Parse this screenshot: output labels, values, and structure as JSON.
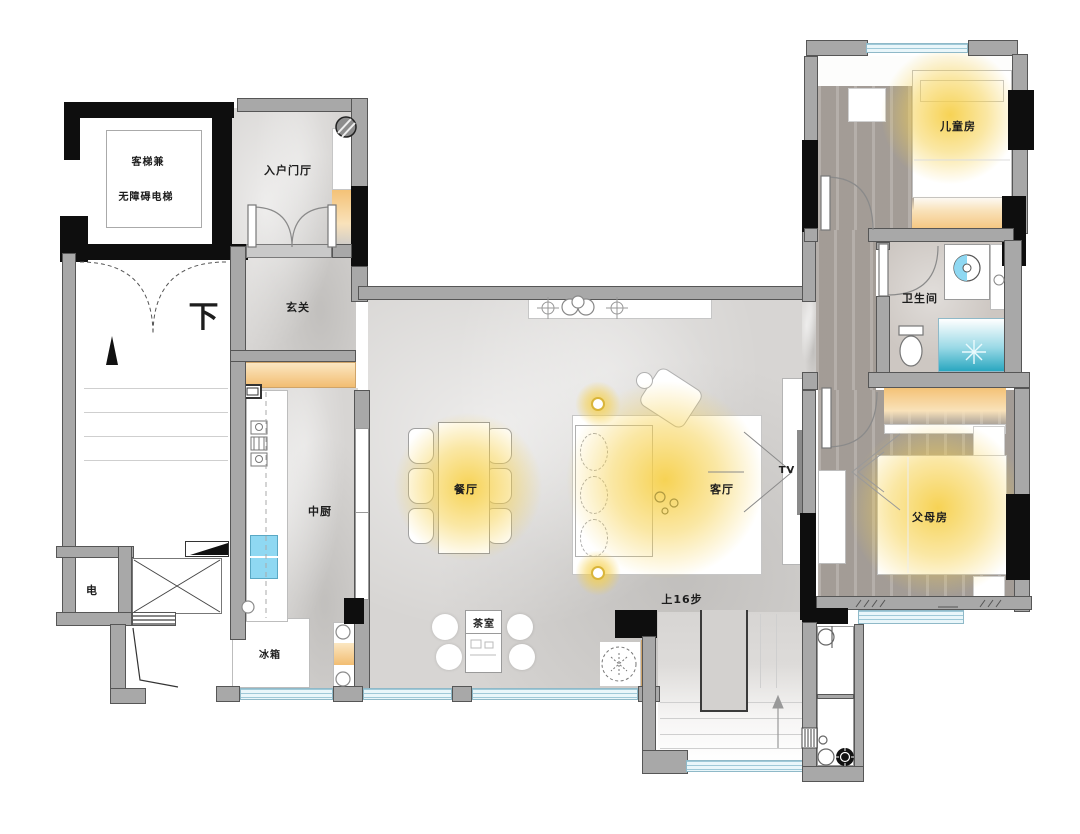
{
  "plan_title": "apartment-floor-plan",
  "rooms": {
    "elevator": {
      "line1": "客梯兼",
      "line2": "无障碍电梯"
    },
    "entry_foyer": {
      "label": "入户门厅"
    },
    "hallway": {
      "label": "玄关"
    },
    "stairs_down": {
      "label": "下"
    },
    "electrical": {
      "label": "电"
    },
    "fridge": {
      "label": "冰箱"
    },
    "kitchen": {
      "label": "中厨"
    },
    "dining": {
      "label": "餐厅"
    },
    "living": {
      "label": "客厅"
    },
    "tea_room": {
      "label": "茶室"
    },
    "tv": {
      "label": "TV"
    },
    "stairs_up": {
      "label": "上16步"
    },
    "kids_room": {
      "label": "儿童房"
    },
    "bathroom": {
      "label": "卫生间"
    },
    "parents_room": {
      "label": "父母房"
    }
  },
  "colors": {
    "marble_floor": "#d7d5d3",
    "wood_floor": "#aba49e",
    "bath_floor": "#cdc7c2",
    "wall_gray": "#a8a8a8",
    "structure_black": "#0e0e0e",
    "window_blue": "#cfe7f0",
    "light_glow": "#f6d04b",
    "warm_cabinet": "#f3c77e",
    "sink_water": "#8fd8f2",
    "shower_teal": "#2aa7c0"
  }
}
